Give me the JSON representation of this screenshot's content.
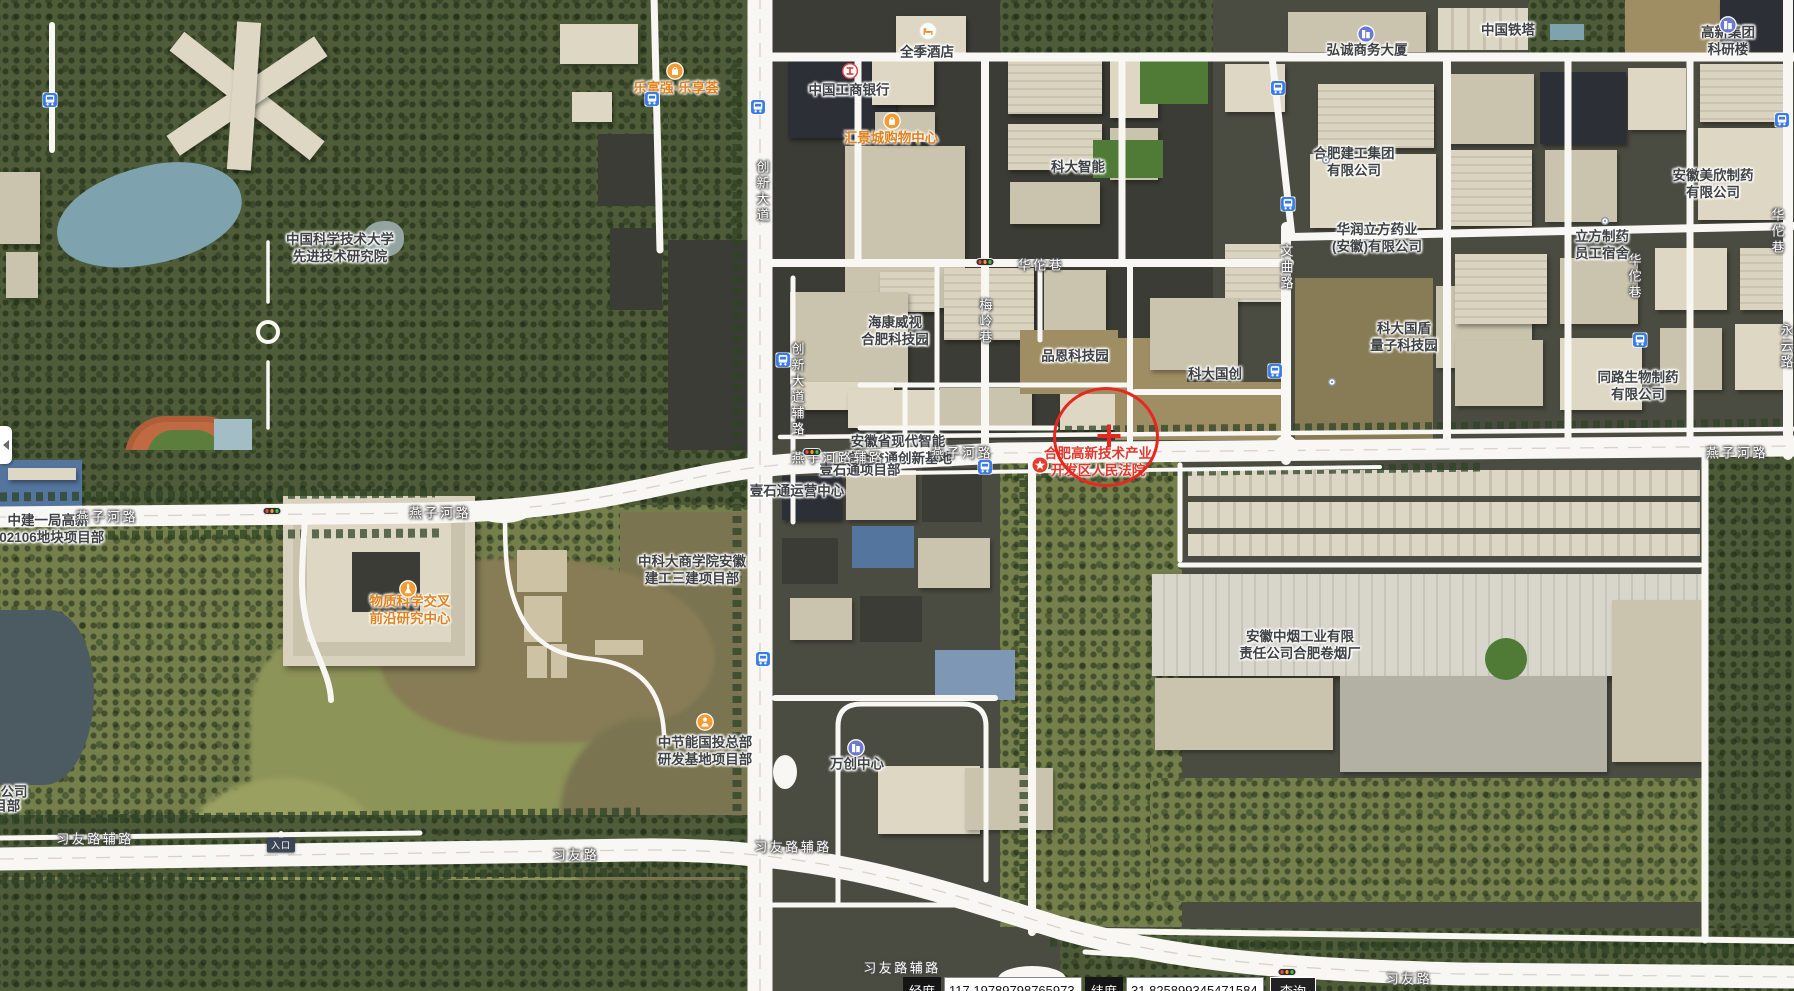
{
  "map": {
    "poi_labels": [
      {
        "lines": [
          "中国科学技术大学",
          "先进技术研究院"
        ],
        "x": 340,
        "y": 249,
        "style": "dark"
      },
      {
        "lines": [
          "全季酒店"
        ],
        "x": 927,
        "y": 53,
        "style": "dark",
        "icon": "hotel-icon",
        "ix": 928,
        "iy": 31
      },
      {
        "lines": [
          "中国工商银行"
        ],
        "x": 849,
        "y": 91,
        "style": "dark",
        "icon": "icbc-icon",
        "ix": 850,
        "iy": 71
      },
      {
        "lines": [
          "汇景城购物中心"
        ],
        "x": 891,
        "y": 139,
        "style": "orange",
        "icon": "shopping-bag-icon",
        "ix": 892,
        "iy": 121
      },
      {
        "lines": [
          "乐富强·乐享荟"
        ],
        "x": 676,
        "y": 89,
        "style": "orange",
        "icon": "shopping-bag-icon",
        "ix": 675,
        "iy": 71
      },
      {
        "lines": [
          "科大智能"
        ],
        "x": 1078,
        "y": 168,
        "style": "dark"
      },
      {
        "lines": [
          "中国铁塔"
        ],
        "x": 1508,
        "y": 31,
        "style": "dark"
      },
      {
        "lines": [
          "弘诚商务大厦"
        ],
        "x": 1367,
        "y": 51,
        "style": "dark",
        "icon": "building-icon",
        "ix": 1366,
        "iy": 34
      },
      {
        "lines": [
          "高新集团科研楼"
        ],
        "x": 1728,
        "y": 42,
        "style": "dark",
        "icon": "building-icon",
        "ix": 1728,
        "iy": 25
      },
      {
        "lines": [
          "合肥建工集团",
          "有限公司"
        ],
        "x": 1354,
        "y": 163,
        "style": "dark"
      },
      {
        "lines": [
          "安徽美欣制药",
          "有限公司"
        ],
        "x": 1713,
        "y": 185,
        "style": "dark"
      },
      {
        "lines": [
          "华润立方药业",
          "(安徽)有限公司"
        ],
        "x": 1377,
        "y": 239,
        "style": "dark"
      },
      {
        "lines": [
          "立方制药",
          "员工宿舍"
        ],
        "x": 1602,
        "y": 246,
        "style": "dark"
      },
      {
        "lines": [
          "科大国盾",
          "量子科技园"
        ],
        "x": 1404,
        "y": 338,
        "style": "dark"
      },
      {
        "lines": [
          "科大国创"
        ],
        "x": 1215,
        "y": 375,
        "style": "dark"
      },
      {
        "lines": [
          "同路生物制药",
          "有限公司"
        ],
        "x": 1638,
        "y": 387,
        "style": "dark"
      },
      {
        "lines": [
          "海康威视",
          "合肥科技园"
        ],
        "x": 895,
        "y": 332,
        "style": "dark"
      },
      {
        "lines": [
          "品恩科技园"
        ],
        "x": 1075,
        "y": 357,
        "style": "dark"
      },
      {
        "lines": [
          "安徽省现代智能",
          "综合交通创新基地"
        ],
        "x": 898,
        "y": 451,
        "style": "dark"
      },
      {
        "lines": [
          "合肥高新技术产业",
          "开发区人民法院"
        ],
        "x": 1098,
        "y": 463,
        "style": "red",
        "icon": "star-icon",
        "ix": 1040,
        "iy": 465
      },
      {
        "lines": [
          "中科大商学院安徽",
          "建工三建项目部"
        ],
        "x": 692,
        "y": 571,
        "style": "dark"
      },
      {
        "lines": [
          "物质科学交叉",
          "前沿研究中心"
        ],
        "x": 410,
        "y": 611,
        "style": "orange",
        "icon": "flask-icon",
        "ix": 408,
        "iy": 589
      },
      {
        "lines": [
          "中建一局高新",
          "202106地块项目部"
        ],
        "x": 48,
        "y": 530,
        "style": "dark"
      },
      {
        "lines": [
          "万创中心"
        ],
        "x": 857,
        "y": 765,
        "style": "dark",
        "icon": "building-icon",
        "ix": 856,
        "iy": 748
      },
      {
        "lines": [
          "中节能国投总部",
          "研发基地项目部"
        ],
        "x": 705,
        "y": 752,
        "style": "dark",
        "icon": "worker-icon",
        "ix": 705,
        "iy": 722
      },
      {
        "lines": [
          "安徽中烟工业有限",
          "责任公司合肥卷烟厂"
        ],
        "x": 1300,
        "y": 646,
        "style": "dark"
      },
      {
        "lines": [
          "壹石通项目部"
        ],
        "x": 860,
        "y": 471,
        "style": "dark"
      },
      {
        "lines": [
          "壹石通运营中心"
        ],
        "x": 797,
        "y": 492,
        "style": "dark"
      },
      {
        "lines": [
          "公司"
        ],
        "x": 14,
        "y": 793,
        "style": "dark"
      },
      {
        "lines": [
          "项目部"
        ],
        "x": 0,
        "y": 807,
        "style": "dark"
      }
    ],
    "road_labels": [
      {
        "text": "燕子河路",
        "x": 107,
        "y": 516
      },
      {
        "text": "燕子河路",
        "x": 440,
        "y": 512
      },
      {
        "text": "燕子河路辅路",
        "x": 838,
        "y": 457
      },
      {
        "text": "燕子河路",
        "x": 962,
        "y": 452
      },
      {
        "text": "燕子河路",
        "x": 1737,
        "y": 452
      },
      {
        "text": "习友路辅路",
        "x": 95,
        "y": 838
      },
      {
        "text": "习友路",
        "x": 576,
        "y": 854
      },
      {
        "text": "习友路辅路",
        "x": 793,
        "y": 846
      },
      {
        "text": "习友路辅路",
        "x": 902,
        "y": 967
      },
      {
        "text": "习友路",
        "x": 1409,
        "y": 978
      },
      {
        "text": "华佗巷",
        "x": 1041,
        "y": 264
      },
      {
        "text": "文曲路",
        "x": 1286,
        "y": 268,
        "vertical": true
      },
      {
        "text": "梅岭巷",
        "x": 985,
        "y": 322,
        "vertical": true
      },
      {
        "text": "创新大道",
        "x": 762,
        "y": 192,
        "vertical": true
      },
      {
        "text": "创新大道辅路",
        "x": 797,
        "y": 390,
        "vertical": true
      },
      {
        "text": "华佗巷",
        "x": 1634,
        "y": 277,
        "vertical": true
      },
      {
        "text": "华佗巷",
        "x": 1777,
        "y": 232,
        "vertical": true
      },
      {
        "text": "永云路",
        "x": 1786,
        "y": 347,
        "vertical": true
      }
    ],
    "bus_stops": [
      {
        "x": 50,
        "y": 100
      },
      {
        "x": 652,
        "y": 99
      },
      {
        "x": 758,
        "y": 107
      },
      {
        "x": 783,
        "y": 360
      },
      {
        "x": 985,
        "y": 467
      },
      {
        "x": 1275,
        "y": 371
      },
      {
        "x": 1640,
        "y": 340
      },
      {
        "x": 1278,
        "y": 88
      },
      {
        "x": 1288,
        "y": 204
      },
      {
        "x": 1782,
        "y": 120
      },
      {
        "x": 763,
        "y": 659
      }
    ],
    "traffic_lights": [
      {
        "x": 985,
        "y": 262
      },
      {
        "x": 272,
        "y": 511
      },
      {
        "x": 812,
        "y": 452
      },
      {
        "x": 1287,
        "y": 972
      }
    ],
    "company_dots": [
      {
        "x": 1326,
        "y": 160
      },
      {
        "x": 1605,
        "y": 221
      },
      {
        "x": 1332,
        "y": 382
      }
    ],
    "marker": {
      "x": 1106,
      "y": 437,
      "rx": 50,
      "ry": 47,
      "cross_x": 1109,
      "cross_y": 436,
      "color": "#e8281e"
    },
    "entrance_badge": {
      "text": "入口",
      "x": 281,
      "y": 845
    }
  },
  "coordinate_bar": {
    "longitude_label": "经度",
    "longitude_value": "117.19789798765973",
    "latitude_label": "纬度",
    "latitude_value": "31.825899345471584",
    "search_button": "查询"
  },
  "colors": {
    "road": "#f8f7f3",
    "marker_red": "#e8281e",
    "poi_orange": "#e0821e",
    "poi_red": "#e2372b",
    "bus_blue": "#3b7ce8"
  }
}
